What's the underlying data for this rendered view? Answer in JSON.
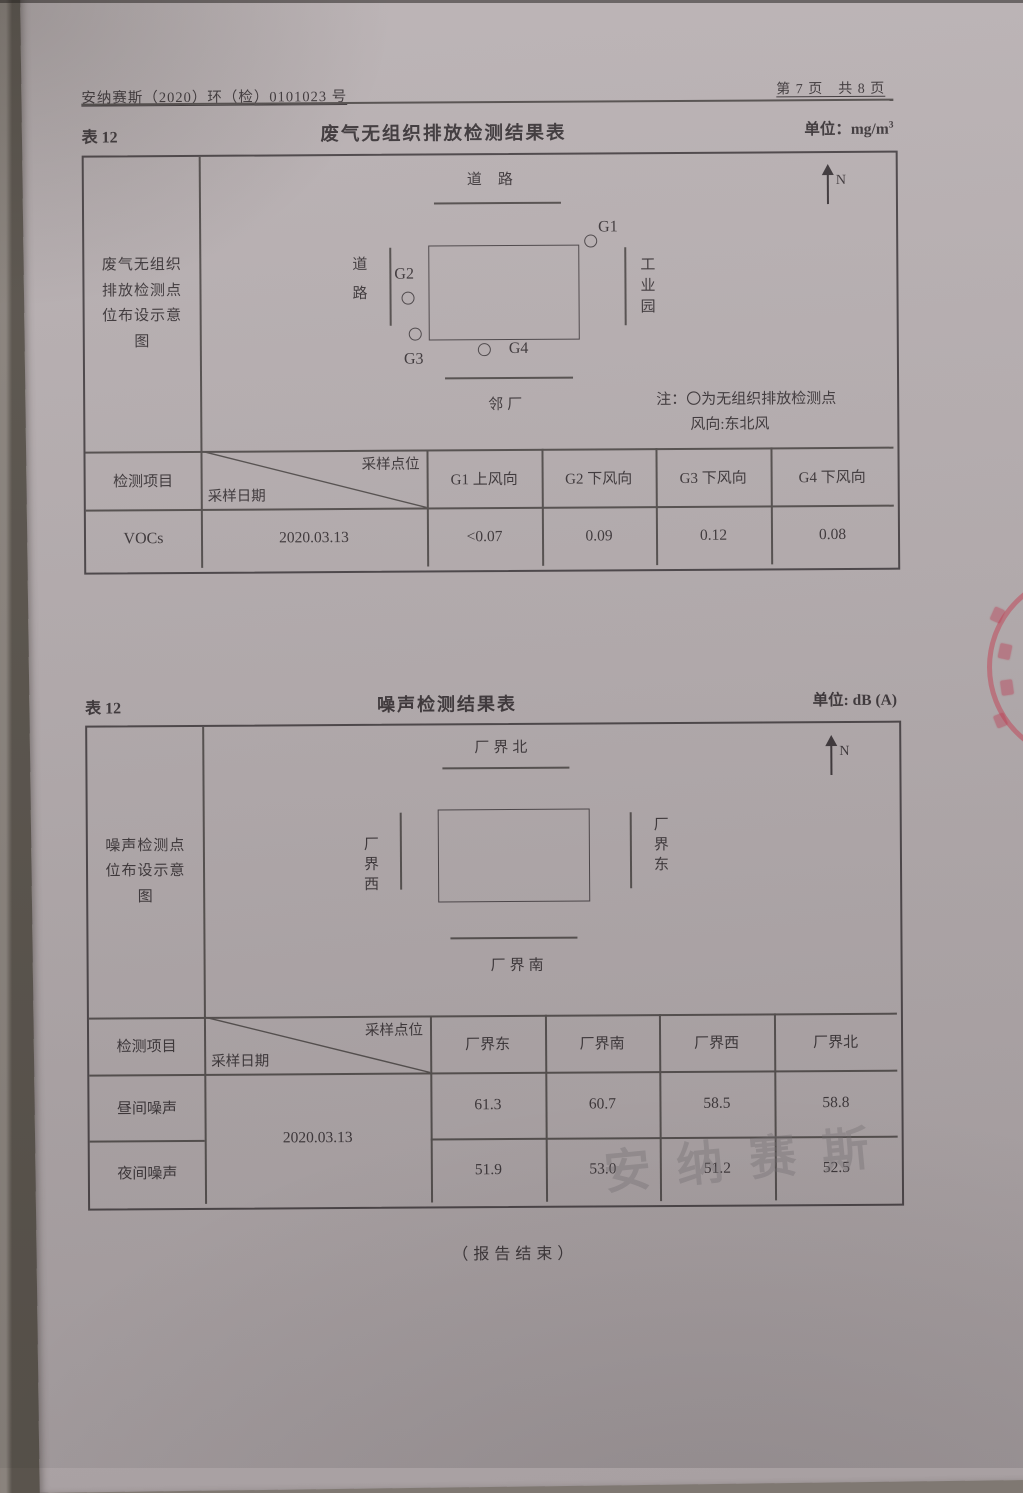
{
  "page": {
    "doc_number": "安纳赛斯（2020）环（检）0101023 号",
    "page_indicator": "第 7 页　共 8 页",
    "end_note": "（报告结束）",
    "watermark": "安纳赛斯"
  },
  "colors": {
    "stamp_red": "#c23e52",
    "paper": "#b3abad",
    "ink": "#3e383b"
  },
  "table1": {
    "label": "表 12",
    "title": "废气无组织排放检测结果表",
    "unit_prefix": "单位：mg/m",
    "unit_sup": "3",
    "diagram_caption": "废气无组织排放检测点位布设示意图",
    "diagram": {
      "top_label": "道路",
      "left_label": "道路",
      "right_label": "工业园",
      "bottom_label": "邻厂",
      "north": "N",
      "points": [
        "G1",
        "G2",
        "G3",
        "G4"
      ],
      "note_line1": "注：〇为无组织排放检测点",
      "note_line2": "风向:东北风"
    },
    "header": {
      "item": "检测项目",
      "corner_top": "采样点位",
      "corner_bottom": "采样日期",
      "columns": [
        "G1 上风向",
        "G2 下风向",
        "G3 下风向",
        "G4 下风向"
      ]
    },
    "row": {
      "item": "VOCs",
      "date": "2020.03.13",
      "values": [
        "<0.07",
        "0.09",
        "0.12",
        "0.08"
      ]
    }
  },
  "table2": {
    "label": "表 12",
    "title": "噪声检测结果表",
    "unit": "单位: dB (A)",
    "diagram_caption": "噪声检测点位布设示意图",
    "diagram": {
      "top_label": "厂界北",
      "left_label": "厂界西",
      "right_label": "厂界东",
      "bottom_label": "厂界南",
      "north": "N"
    },
    "header": {
      "item": "检测项目",
      "corner_top": "采样点位",
      "corner_bottom": "采样日期",
      "columns": [
        "厂界东",
        "厂界南",
        "厂界西",
        "厂界北"
      ]
    },
    "date": "2020.03.13",
    "rows": [
      {
        "item": "昼间噪声",
        "values": [
          "61.3",
          "60.7",
          "58.5",
          "58.8"
        ]
      },
      {
        "item": "夜间噪声",
        "values": [
          "51.9",
          "53.0",
          "51.2",
          "52.5"
        ]
      }
    ]
  }
}
